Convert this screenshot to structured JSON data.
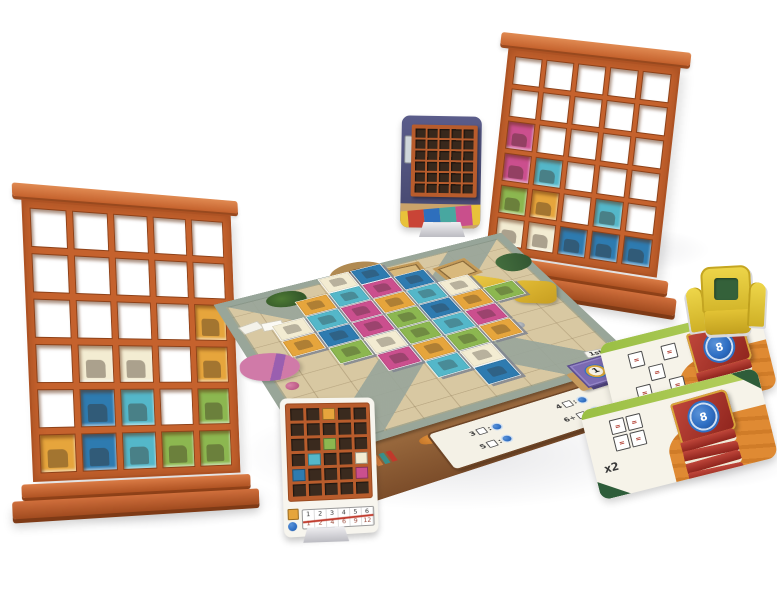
{
  "scene": {
    "description": "3D product render of a shelf-building board game: two wooden bookshelf player boards, a living-room board covered with item tiles, goal cards with book-shaped scoring tokens, cards on plastic stands and a miniature armchair"
  },
  "colors": {
    "background": "#ffffff",
    "shelf_wood": "#c5622d",
    "shelf_wood_dark": "#9a4a1f",
    "shelf_wood_light": "#de8049",
    "board_floor": "#d8c8a2",
    "board_path": "#9dac9e",
    "board_wood": "#8b5a35",
    "card_parchment": "#f6f3e9",
    "card_band_green": "#9abf44",
    "card_corner_green": "#2e5d3a",
    "card_orange": "#df8a33",
    "token_red": "#a93430",
    "rosette_blue": "#2f6fc4",
    "end_tile_purple": "#7b6ab2",
    "chair_yellow": "#e7cc3a",
    "chair_cushion": "#34613a",
    "stand_gray": "#d6d6da",
    "tiles": {
      "books": "#f3ecd2",
      "games": "#e6a53c",
      "trophies": "#54b7c9",
      "plants": "#cb4f8e",
      "cats": "#8cb750",
      "frames": "#2e7bb0"
    },
    "rug_stripes": [
      "#e8c23a",
      "#c94436",
      "#2e6fbd",
      "#48a7a0",
      "#c94f8c",
      "#e8c23a"
    ]
  },
  "left_shelf": {
    "rows": 6,
    "cols": 5,
    "cells": [
      [
        "",
        "",
        "",
        "",
        ""
      ],
      [
        "",
        "",
        "",
        "",
        ""
      ],
      [
        "",
        "",
        "",
        "",
        "games"
      ],
      [
        "",
        "books",
        "books",
        "",
        "games"
      ],
      [
        "",
        "frames",
        "trophies",
        "",
        "cats"
      ],
      [
        "games",
        "frames",
        "trophies",
        "cats",
        "cats"
      ]
    ]
  },
  "right_shelf": {
    "rows": 6,
    "cols": 5,
    "cells": [
      [
        "",
        "",
        "",
        "",
        ""
      ],
      [
        "",
        "",
        "",
        "",
        ""
      ],
      [
        "plants",
        "",
        "",
        "",
        ""
      ],
      [
        "plants",
        "trophies",
        "",
        "",
        ""
      ],
      [
        "cats",
        "games",
        "",
        "trophies",
        ""
      ],
      [
        "books",
        "books",
        "frames",
        "frames",
        "frames"
      ]
    ]
  },
  "room_card": {
    "rows": 6,
    "cols": 5
  },
  "board": {
    "grid_size": 9,
    "tiles": [
      {
        "r": 0,
        "c": 3,
        "t": "books"
      },
      {
        "r": 0,
        "c": 4,
        "t": "frames"
      },
      {
        "r": 1,
        "c": 2,
        "t": "games"
      },
      {
        "r": 1,
        "c": 3,
        "t": "trophies"
      },
      {
        "r": 1,
        "c": 4,
        "t": "plants"
      },
      {
        "r": 1,
        "c": 5,
        "t": "frames"
      },
      {
        "r": 2,
        "c": 1,
        "t": "books"
      },
      {
        "r": 2,
        "c": 2,
        "t": "trophies"
      },
      {
        "r": 2,
        "c": 3,
        "t": "plants"
      },
      {
        "r": 2,
        "c": 4,
        "t": "games"
      },
      {
        "r": 2,
        "c": 5,
        "t": "trophies"
      },
      {
        "r": 2,
        "c": 6,
        "t": "books"
      },
      {
        "r": 3,
        "c": 1,
        "t": "games"
      },
      {
        "r": 3,
        "c": 2,
        "t": "frames"
      },
      {
        "r": 3,
        "c": 3,
        "t": "plants"
      },
      {
        "r": 3,
        "c": 4,
        "t": "cats"
      },
      {
        "r": 3,
        "c": 5,
        "t": "frames"
      },
      {
        "r": 3,
        "c": 6,
        "t": "games"
      },
      {
        "r": 3,
        "c": 7,
        "t": "cats"
      },
      {
        "r": 4,
        "c": 2,
        "t": "cats"
      },
      {
        "r": 4,
        "c": 3,
        "t": "books"
      },
      {
        "r": 4,
        "c": 4,
        "t": "cats"
      },
      {
        "r": 4,
        "c": 5,
        "t": "trophies"
      },
      {
        "r": 4,
        "c": 6,
        "t": "plants"
      },
      {
        "r": 5,
        "c": 3,
        "t": "plants"
      },
      {
        "r": 5,
        "c": 4,
        "t": "games"
      },
      {
        "r": 5,
        "c": 5,
        "t": "cats"
      },
      {
        "r": 5,
        "c": 6,
        "t": "games"
      },
      {
        "r": 6,
        "c": 4,
        "t": "trophies"
      },
      {
        "r": 6,
        "c": 5,
        "t": "books"
      },
      {
        "r": 7,
        "c": 5,
        "t": "frames"
      }
    ],
    "bookshelf_colors": [
      "#c0392b",
      "#2e6fbd",
      "#e2a23c",
      "#5a8f3c",
      "#7a4a8f",
      "#d07a3a",
      "#3a8f8a",
      "#c0392b"
    ],
    "scoring": {
      "items": [
        {
          "count": "3"
        },
        {
          "count": "4"
        },
        {
          "count": "5"
        },
        {
          "count": "6+"
        }
      ]
    },
    "end_tile": {
      "value": "1",
      "label": "1st"
    }
  },
  "personal_card": {
    "rows": 6,
    "cols": 5,
    "grid": [
      [
        "",
        "",
        "games",
        "",
        ""
      ],
      [
        "",
        "",
        "",
        "",
        ""
      ],
      [
        "",
        "",
        "cats",
        "",
        ""
      ],
      [
        "",
        "trophies",
        "",
        "",
        "books"
      ],
      [
        "frames",
        "",
        "",
        "",
        "plants"
      ],
      [
        "",
        "",
        "",
        "",
        ""
      ]
    ],
    "track": {
      "matches": [
        "1",
        "2",
        "3",
        "4",
        "5",
        "6"
      ],
      "points": [
        "1",
        "2",
        "4",
        "6",
        "9",
        "12"
      ]
    }
  },
  "goal_cards": [
    {
      "token": "8",
      "symbol": "=",
      "cells": [
        [
          0,
          0
        ],
        [
          0,
          2
        ],
        [
          1,
          1
        ],
        [
          2,
          0
        ],
        [
          2,
          2
        ]
      ],
      "note": ""
    },
    {
      "token": "8",
      "symbol": "=",
      "cells": [
        [
          0,
          0
        ],
        [
          0,
          1
        ],
        [
          1,
          0
        ],
        [
          1,
          1
        ]
      ],
      "note": "x2"
    }
  ]
}
